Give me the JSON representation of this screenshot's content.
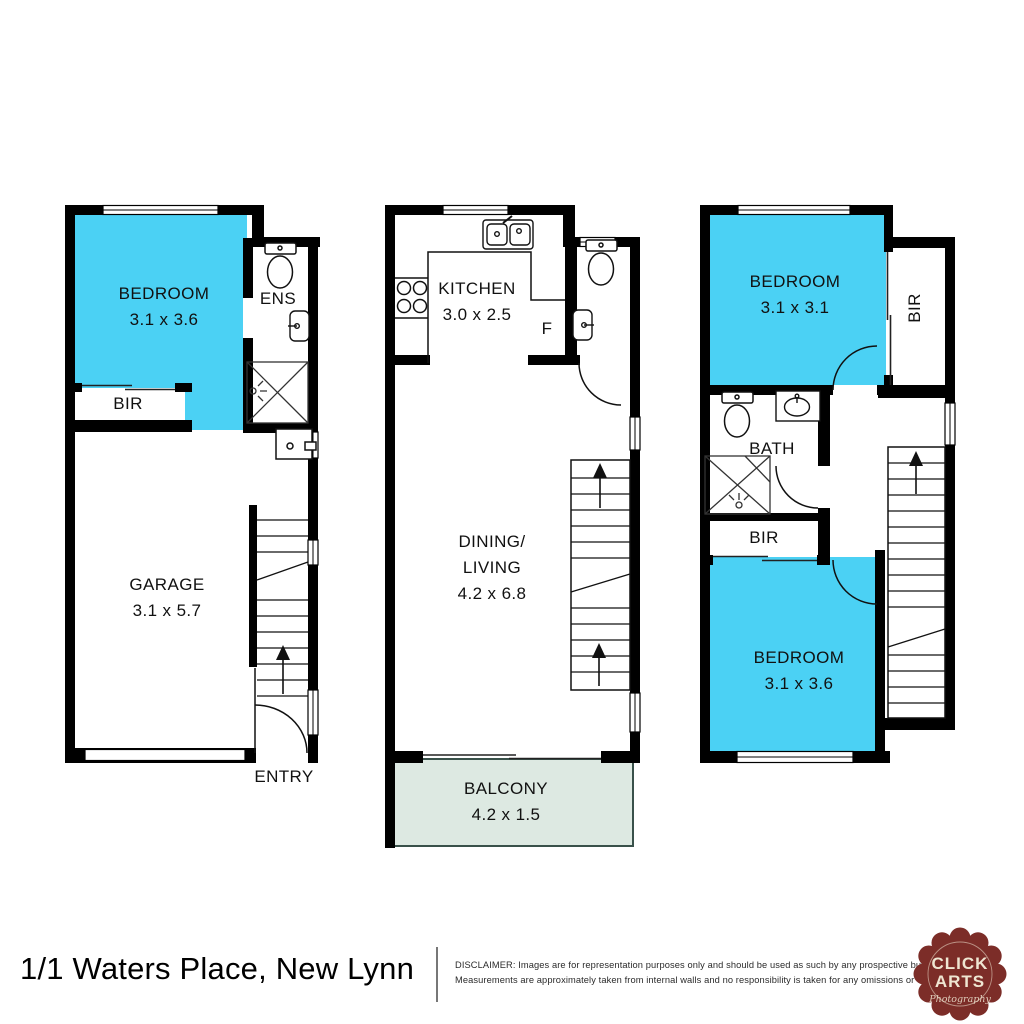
{
  "plans": [
    {
      "rooms": {
        "bedroom": {
          "name": "BEDROOM",
          "dims": "3.1 x 3.6"
        },
        "ens": {
          "name": "ENS"
        },
        "bir": {
          "name": "BIR"
        },
        "garage": {
          "name": "GARAGE",
          "dims": "3.1 x 5.7"
        },
        "entry": {
          "name": "ENTRY"
        }
      }
    },
    {
      "rooms": {
        "kitchen": {
          "name": "KITCHEN",
          "dims": "3.0 x 2.5"
        },
        "fridge": {
          "name": "F"
        },
        "dining_living": {
          "line1": "DINING/",
          "line2": "LIVING",
          "dims": "4.2 x 6.8"
        },
        "balcony": {
          "name": "BALCONY",
          "dims": "4.2 x 1.5"
        }
      }
    },
    {
      "rooms": {
        "bedroom_top": {
          "name": "BEDROOM",
          "dims": "3.1 x 3.1"
        },
        "bir_side": {
          "name": "BIR"
        },
        "bath": {
          "name": "BATH"
        },
        "bir_mid": {
          "name": "BIR"
        },
        "bedroom_bottom": {
          "name": "BEDROOM",
          "dims": "3.1 x 3.6"
        }
      }
    }
  ],
  "footer": {
    "address": "1/1 Waters Place, New Lynn",
    "disclaimer_line1": "DISCLAIMER: Images are for representation purposes only and should be used as such by any prospective buyer.",
    "disclaimer_line2": "Measurements are approximately taken from internal walls and no responsibility is taken for any omissions or errors."
  },
  "logo": {
    "line1": "CLICK",
    "line2": "ARTS",
    "tagline": "Photography"
  },
  "colors": {
    "highlight_cyan": "#4bd1f4",
    "balcony_green": "#dde9e2",
    "wall_black": "#000000",
    "line_dark": "#111111",
    "badge_maroon": "#7c2d28",
    "badge_cream": "#efe6d2"
  }
}
